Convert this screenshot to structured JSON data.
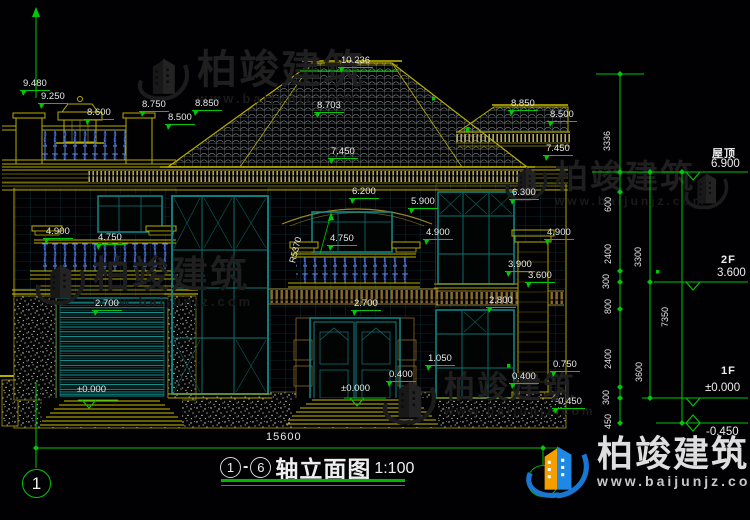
{
  "drawing_title": {
    "prefix_axis": "1",
    "separator": "-",
    "suffix_axis": "6",
    "label": "轴立面图",
    "scale": "1:100"
  },
  "axis_bubble_left": "1",
  "overall_width_dim": "15600",
  "brand": {
    "name": "柏竣建筑",
    "url": "www.baijunjz.com"
  },
  "levels": [
    {
      "name": "屋顶",
      "value": "6.900"
    },
    {
      "name": "2F",
      "value": "3.600"
    },
    {
      "name": "1F",
      "value": "±0.000"
    },
    {
      "name": "",
      "value": "-0.450"
    }
  ],
  "elevation_marks": [
    {
      "t": "9.480",
      "x": 20,
      "y": 79
    },
    {
      "t": "9.250",
      "x": 38,
      "y": 92
    },
    {
      "t": "8.600",
      "x": 84,
      "y": 108
    },
    {
      "t": "8.750",
      "x": 139,
      "y": 100
    },
    {
      "t": "8.500",
      "x": 165,
      "y": 113
    },
    {
      "t": "8.850",
      "x": 192,
      "y": 99
    },
    {
      "t": "10.236",
      "x": 338,
      "y": 56
    },
    {
      "t": "8.703",
      "x": 314,
      "y": 101
    },
    {
      "t": "7.450",
      "x": 328,
      "y": 147
    },
    {
      "t": "8.850",
      "x": 508,
      "y": 99
    },
    {
      "t": "8.500",
      "x": 547,
      "y": 110
    },
    {
      "t": "7.450",
      "x": 543,
      "y": 144
    },
    {
      "t": "6.200",
      "x": 349,
      "y": 187
    },
    {
      "t": "5.900",
      "x": 408,
      "y": 197
    },
    {
      "t": "6.300",
      "x": 509,
      "y": 188
    },
    {
      "t": "4.900",
      "x": 43,
      "y": 227
    },
    {
      "t": "4.750",
      "x": 95,
      "y": 233
    },
    {
      "t": "4.750",
      "x": 327,
      "y": 234
    },
    {
      "t": "4.900",
      "x": 423,
      "y": 228
    },
    {
      "t": "4.900",
      "x": 544,
      "y": 228
    },
    {
      "t": "3.900",
      "x": 505,
      "y": 260
    },
    {
      "t": "3.600",
      "x": 525,
      "y": 271
    },
    {
      "t": "2.700",
      "x": 92,
      "y": 299
    },
    {
      "t": "2.700",
      "x": 351,
      "y": 299
    },
    {
      "t": "2.800",
      "x": 486,
      "y": 296
    },
    {
      "t": "1.050",
      "x": 425,
      "y": 354
    },
    {
      "t": "0.400",
      "x": 386,
      "y": 370
    },
    {
      "t": "0.400",
      "x": 509,
      "y": 372
    },
    {
      "t": "0.750",
      "x": 550,
      "y": 360
    },
    {
      "t": "-0.450",
      "x": 552,
      "y": 397
    }
  ],
  "zero_marks": [
    {
      "t": "±0.000",
      "x": 77,
      "y": 385
    },
    {
      "t": "±0.000",
      "x": 341,
      "y": 384
    }
  ],
  "chain_dims": [
    {
      "t": "3336",
      "x": 612,
      "y": 142
    },
    {
      "t": "600",
      "x": 613,
      "y": 203
    },
    {
      "t": "2400",
      "x": 613,
      "y": 255
    },
    {
      "t": "300",
      "x": 611,
      "y": 280
    },
    {
      "t": "800",
      "x": 613,
      "y": 305
    },
    {
      "t": "2400",
      "x": 613,
      "y": 360
    },
    {
      "t": "300",
      "x": 611,
      "y": 396
    },
    {
      "t": "450",
      "x": 613,
      "y": 420
    },
    {
      "t": "3300",
      "x": 643,
      "y": 258
    },
    {
      "t": "3600",
      "x": 644,
      "y": 373
    },
    {
      "t": "7350",
      "x": 670,
      "y": 318
    }
  ],
  "radius_note": "R5370",
  "watermarks": [
    {
      "x": 136,
      "y": 50,
      "icon": 54,
      "fs": 40,
      "ufs": 13,
      "theme": "dark",
      "with_text": true
    },
    {
      "x": 504,
      "y": 160,
      "icon": 44,
      "fs": 33,
      "ufs": 12,
      "theme": "dark",
      "with_text": true
    },
    {
      "x": 34,
      "y": 256,
      "icon": 52,
      "fs": 37,
      "ufs": 13,
      "theme": "dark",
      "with_text": true
    },
    {
      "x": 381,
      "y": 372,
      "icon": 56,
      "fs": 31,
      "ufs": 12,
      "theme": "dark",
      "with_text": true
    },
    {
      "x": 683,
      "y": 166,
      "icon": 46,
      "fs": 0,
      "ufs": 0,
      "theme": "dark",
      "with_text": false
    },
    {
      "x": 524,
      "y": 436,
      "icon": 66,
      "fs": 36,
      "ufs": 14,
      "theme": "color",
      "with_text": true
    }
  ]
}
